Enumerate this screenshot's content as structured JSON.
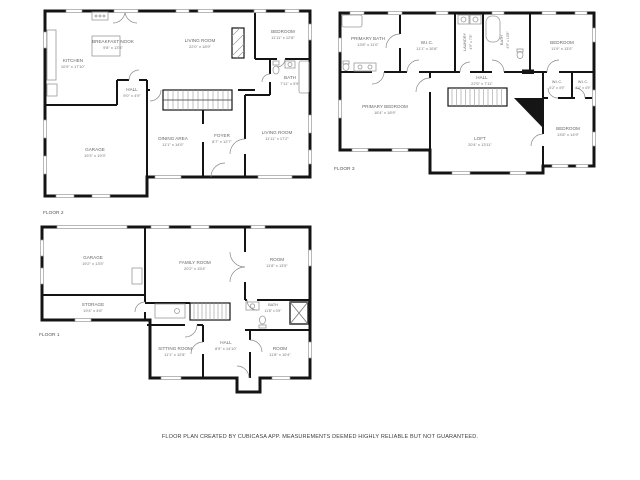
{
  "colors": {
    "wall": "#141414",
    "label_text": "#666666",
    "fixture": "#9a9a9a"
  },
  "footer": {
    "disclaimer": "FLOOR PLAN CREATED BY CUBICASA APP. MEASUREMENTS DEEMED HIGHLY RELIABLE BUT NOT GUARANTEED."
  },
  "floors": [
    {
      "label": "FLOOR 2",
      "rooms": [
        {
          "name": "KITCHEN",
          "dims": "10'9\" x 17'10\""
        },
        {
          "name": "BREAKFAST NOOK",
          "dims": "9'8\" x 13'5\""
        },
        {
          "name": "LIVING ROOM",
          "dims": "22'0\" x 18'9\""
        },
        {
          "name": "BEDROOM",
          "dims": "11'11\" x 12'8\""
        },
        {
          "name": "HALL",
          "dims": "9'0\" x 4'9\""
        },
        {
          "name": "BATH",
          "dims": "7'11\" x 5'9\""
        },
        {
          "name": "DINING AREA",
          "dims": "11'1\" x 14'0\""
        },
        {
          "name": "FOYER",
          "dims": "8'7\" x 12'7\""
        },
        {
          "name": "LIVING ROOM",
          "dims": "11'11\" x 17'2\""
        },
        {
          "name": "GARAGE",
          "dims": "19'3\" x 19'3\""
        }
      ]
    },
    {
      "label": "FLOOR 3",
      "rooms": [
        {
          "name": "PRIMARY BATH",
          "dims": "13'8\" x 11'0\""
        },
        {
          "name": "W.I.C.",
          "dims": "11'1\" x 10'8\""
        },
        {
          "name": "LAUNDRY",
          "dims": "4'9\" x 7'8\""
        },
        {
          "name": "BATH",
          "dims": "4'9\" x 10'8\""
        },
        {
          "name": "BEDROOM",
          "dims": "11'9\" x 13'0\""
        },
        {
          "name": "HALL",
          "dims": "22'5\" x 7'11\""
        },
        {
          "name": "PRIMARY BEDROOM",
          "dims": "18'4\" x 18'9\""
        },
        {
          "name": "LOFT",
          "dims": "20'4\" x 13'11\""
        },
        {
          "name": "BEDROOM",
          "dims": "13'8\" x 14'9\""
        },
        {
          "name": "W.I.C.",
          "dims": "6'2\" x 4'9\""
        },
        {
          "name": "W.I.C.",
          "dims": "4'4\" x 4'9\""
        }
      ]
    },
    {
      "label": "FLOOR 1",
      "rooms": [
        {
          "name": "GARAGE",
          "dims": "19'2\" x 13'5\""
        },
        {
          "name": "STORAGE",
          "dims": "19'4\" x 4'6\""
        },
        {
          "name": "FAMILY ROOM",
          "dims": "20'2\" x 15'4\""
        },
        {
          "name": "ROOM",
          "dims": "11'8\" x 13'5\""
        },
        {
          "name": "BATH",
          "dims": "11'8\" x 3'9\""
        },
        {
          "name": "SITTING ROOM",
          "dims": "11'1\" x 12'8\""
        },
        {
          "name": "HALL",
          "dims": "8'9\" x 14'10\""
        },
        {
          "name": "ROOM",
          "dims": "11'8\" x 10'4\""
        }
      ]
    }
  ]
}
